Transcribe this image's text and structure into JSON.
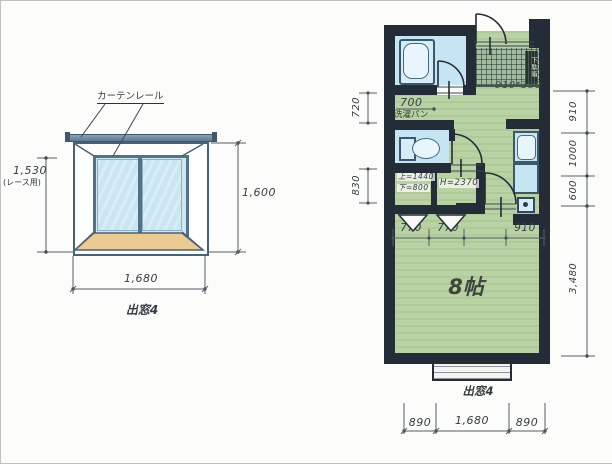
{
  "window_detail": {
    "curtain_rail_label": "カーテンレール",
    "dim_left_value": "1,530",
    "dim_left_note": "(レース用)",
    "dim_right_value": "1,600",
    "dim_bottom_value": "1,680",
    "caption": "出窓4"
  },
  "floor_plan": {
    "room_label": "8帖",
    "entrance_size_label": "910*390",
    "shoe_cabinet_label": "下駄箱",
    "washing_pan": {
      "dim": "700",
      "label": "洗濯パン"
    },
    "closet_left_line1": "上=1440",
    "closet_left_line2": "下=800",
    "closet_right_label": "H=2370",
    "caption": "出窓4",
    "dims": {
      "left": [
        "720",
        "830"
      ],
      "right": [
        "910",
        "1000",
        "600",
        "3,480"
      ],
      "interior": [
        "770",
        "770",
        "910"
      ],
      "bottom": [
        "890",
        "1,680",
        "890"
      ]
    }
  },
  "colors": {
    "wall": "#242c38",
    "room_floor": "#b9d2a3",
    "wet_area_floor": "#c6e5f2",
    "entrance_tile": "#a3bba0",
    "window_sill": "#eccb92",
    "glass": "#c9e6f3"
  }
}
